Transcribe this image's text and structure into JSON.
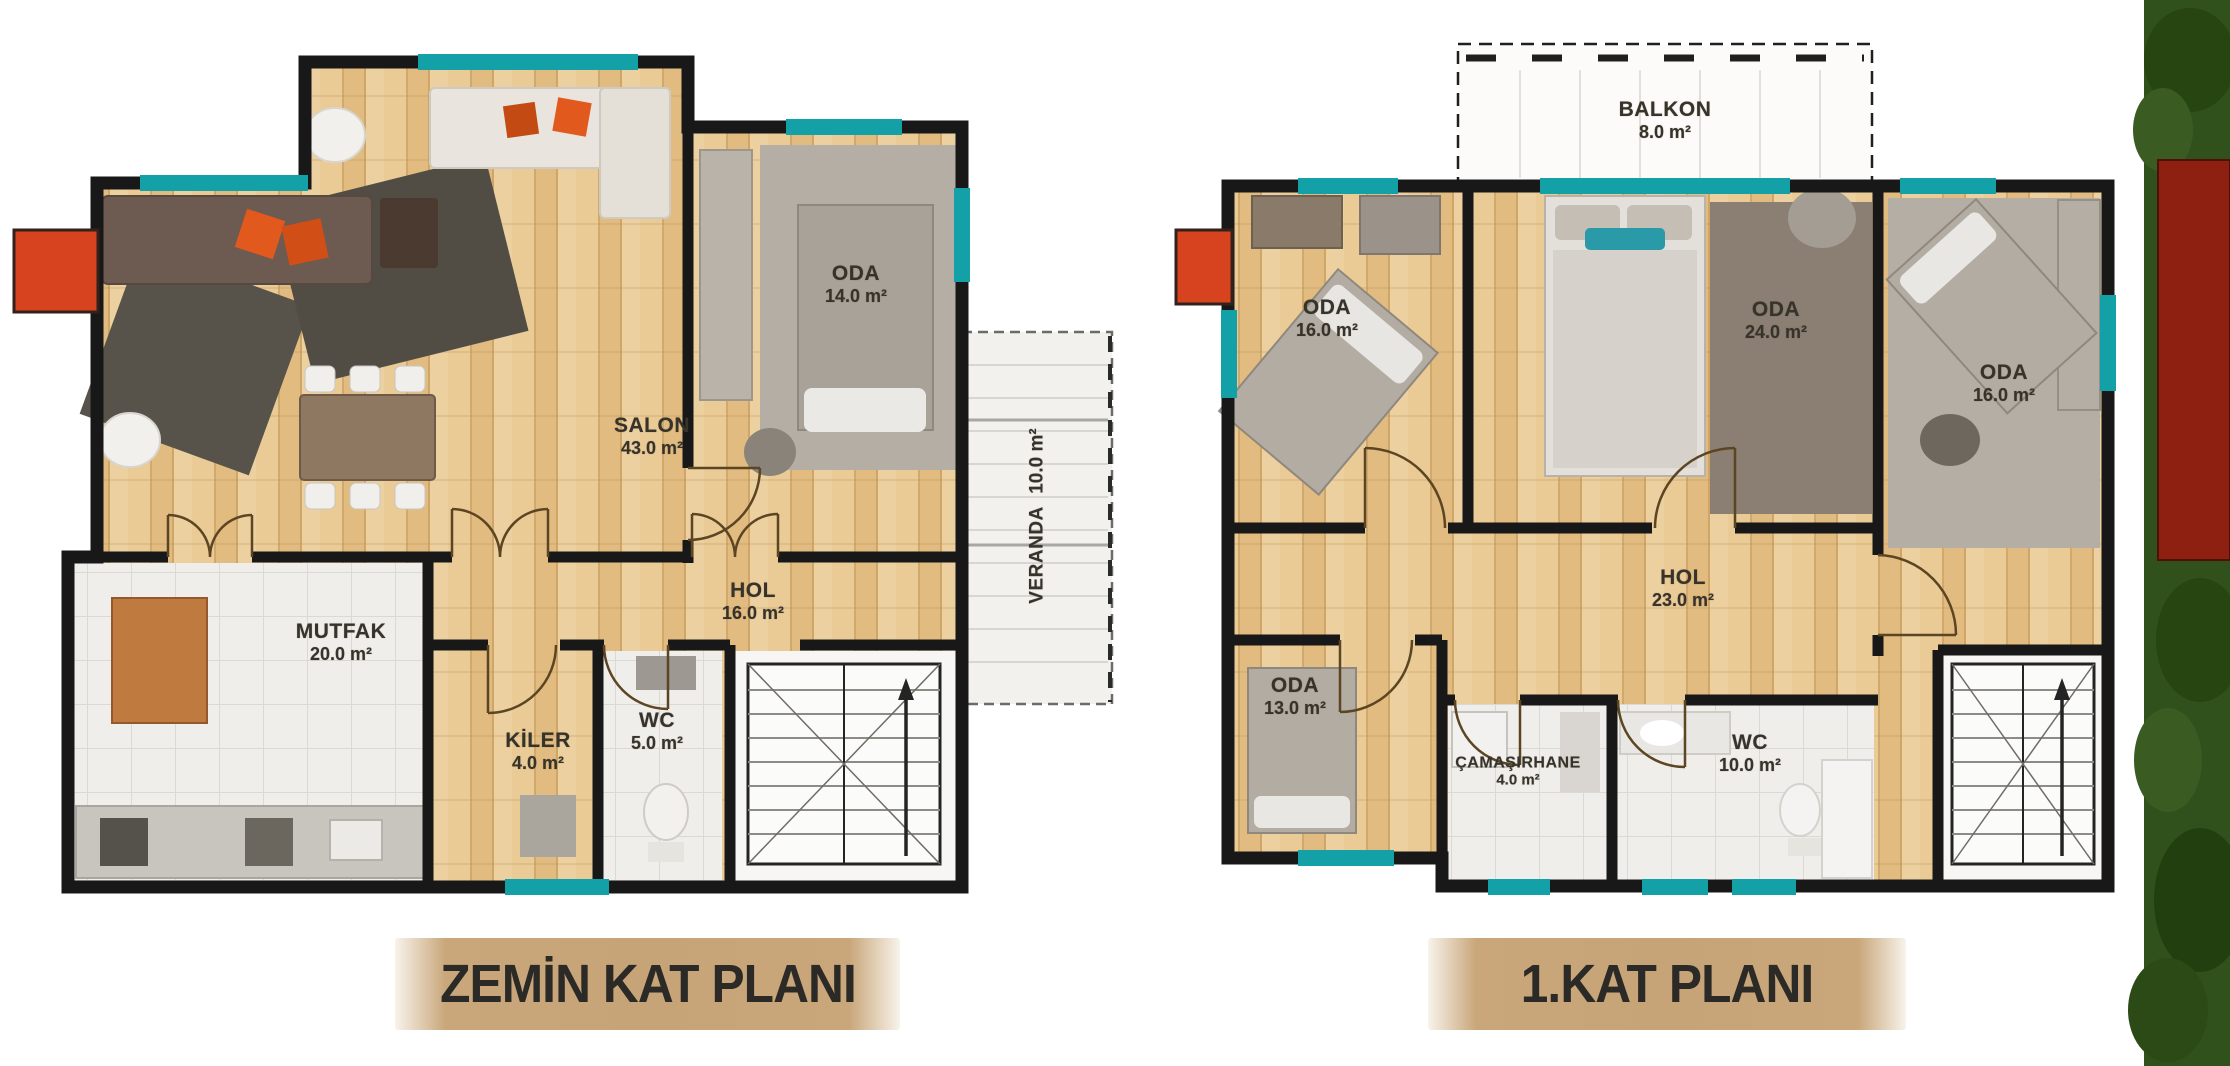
{
  "image_title": "Villa floor plans",
  "colors": {
    "wall": "#181818",
    "window_teal": "#13a1a7",
    "chimney_red": "#d7431e",
    "wood_floor": "#e6c28a",
    "tile_floor": "#efeeeb",
    "title_band": "#c9a77b",
    "title_text": "#2b2a27",
    "label_text": "#37332a",
    "foliage_green": "#30501c",
    "red_block": "#8d2011"
  },
  "plans": [
    {
      "title": "ZEMİN KAT PLANI",
      "rooms": [
        {
          "name": "ODA",
          "area": "14.0 m²"
        },
        {
          "name": "SALON",
          "area": "43.0 m²"
        },
        {
          "name": "HOL",
          "area": "16.0 m²"
        },
        {
          "name": "MUTFAK",
          "area": "20.0 m²"
        },
        {
          "name": "KİLER",
          "area": "4.0 m²"
        },
        {
          "name": "WC",
          "area": "5.0 m²"
        },
        {
          "name": "VERANDA",
          "area": "10.0 m²"
        }
      ]
    },
    {
      "title": "1.KAT PLANI",
      "rooms": [
        {
          "name": "BALKON",
          "area": "8.0 m²"
        },
        {
          "name": "ODA",
          "area": "16.0 m²"
        },
        {
          "name": "ODA",
          "area": "24.0 m²"
        },
        {
          "name": "ODA",
          "area": "16.0 m²"
        },
        {
          "name": "HOL",
          "area": "23.0 m²"
        },
        {
          "name": "ODA",
          "area": "13.0 m²"
        },
        {
          "name": "ÇAMAŞIRHANE",
          "area": "4.0 m²"
        },
        {
          "name": "WC",
          "area": "10.0 m²"
        }
      ]
    }
  ]
}
